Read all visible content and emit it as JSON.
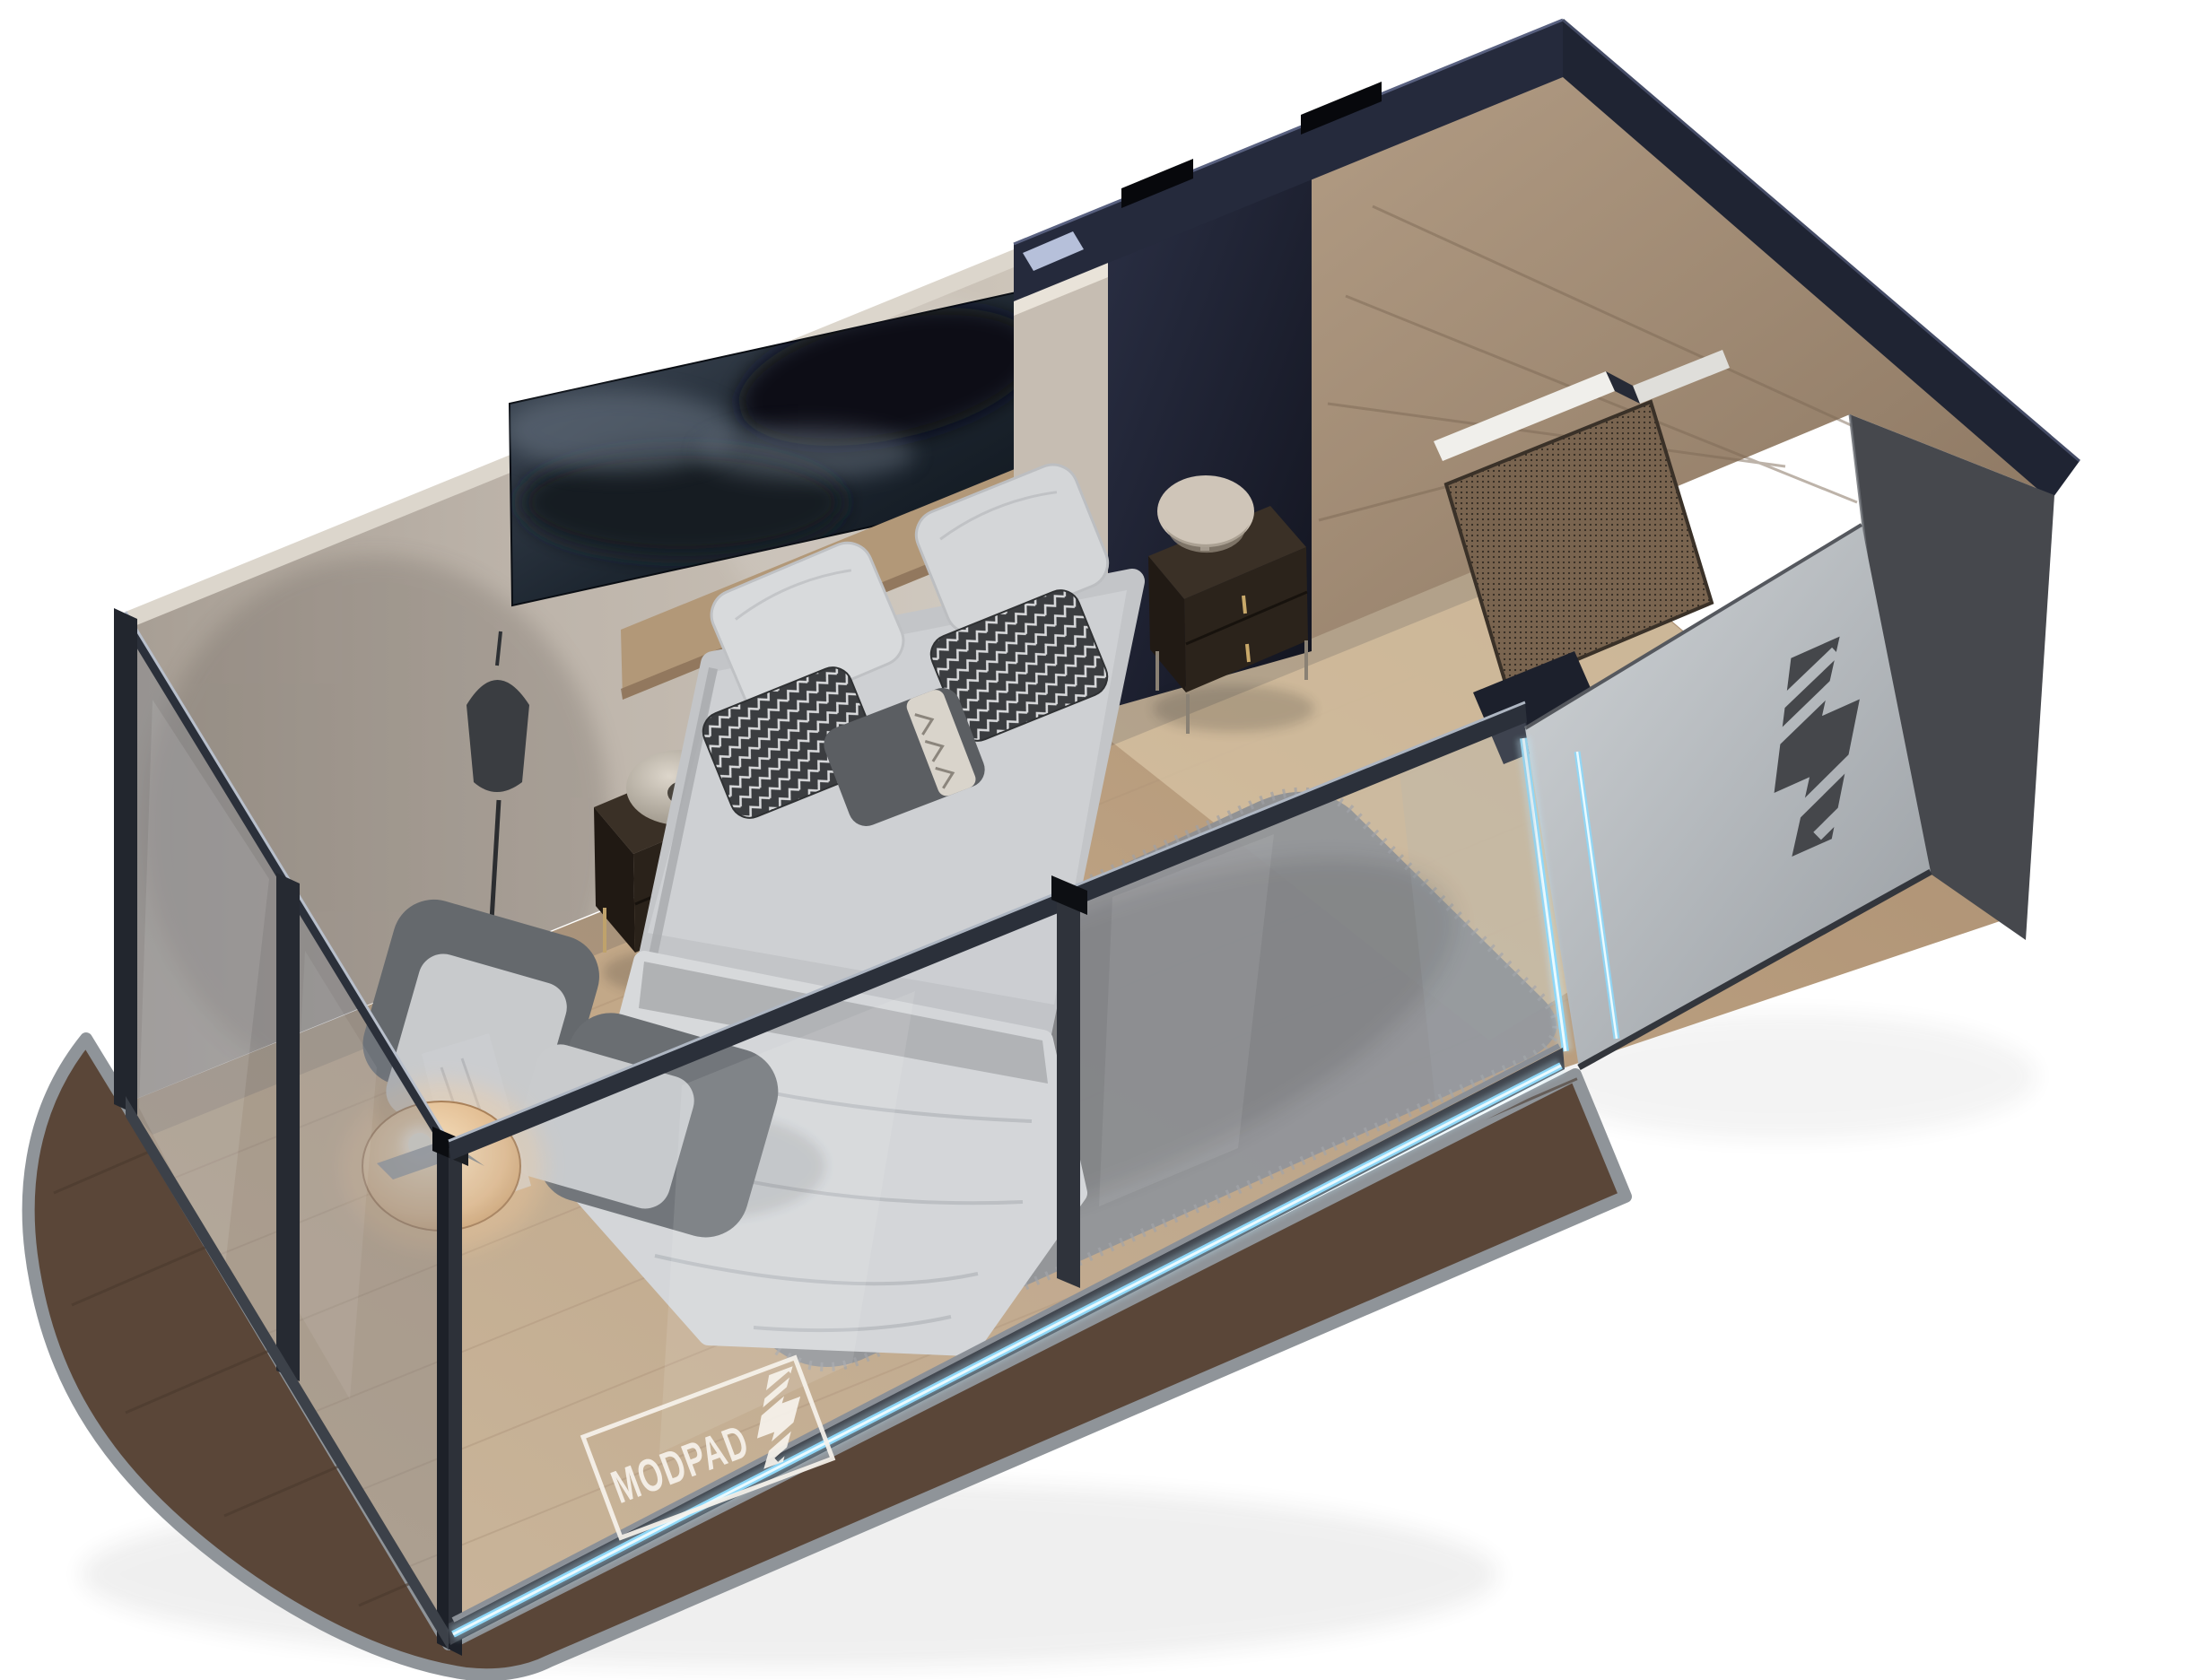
{
  "image": {
    "type": "3d-isometric-cutaway-render",
    "subject": "MODPADZ modular pod bedroom unit",
    "background": "#ffffff"
  },
  "watermark": {
    "text": "MODPAD",
    "mark_icon": "modpadz-bolt-z-icon",
    "color": "#f7f3ec"
  },
  "door_logo": {
    "icon": "modpadz-bolt-z-icon",
    "color": "#45474b"
  },
  "colors": {
    "accent_led": "#8fd8f8",
    "led_core": "#eafaff",
    "deck_wood": "#5a4638",
    "deck_rim": "#8f9499",
    "floor_wood": "#c4ab8c",
    "wall_beige": "#bdb4aa",
    "frame_navy": "#252a3c",
    "glass_tint": "#7d828c",
    "door_panel": "#b9bec2",
    "oak_wall": "#a08b74",
    "charcoal_panel": "#46484d",
    "bedding": "#c7c9cb",
    "rug": "#8d8f93",
    "chair_shell": "#65696d",
    "chair_seat": "#c8cacc",
    "nightstand": "#302820",
    "table_glow": "#e8c9a0",
    "artwork_dark": "#101720"
  },
  "scene": {
    "objects": [
      "glass-walled pod shell",
      "walnut deck base with metal rim",
      "double bed with gray bedding and chevron pillows",
      "wall artwork above headboard",
      "left nightstand with disc lamp",
      "right nightstand with mushroom lamp",
      "black floor lamp",
      "two gray lounge chairs",
      "round side table with lit lamp",
      "gray shag rug",
      "oak bathroom partition with mesh door",
      "entry panel with bolt-Z logo",
      "blue LED edge lighting"
    ]
  }
}
